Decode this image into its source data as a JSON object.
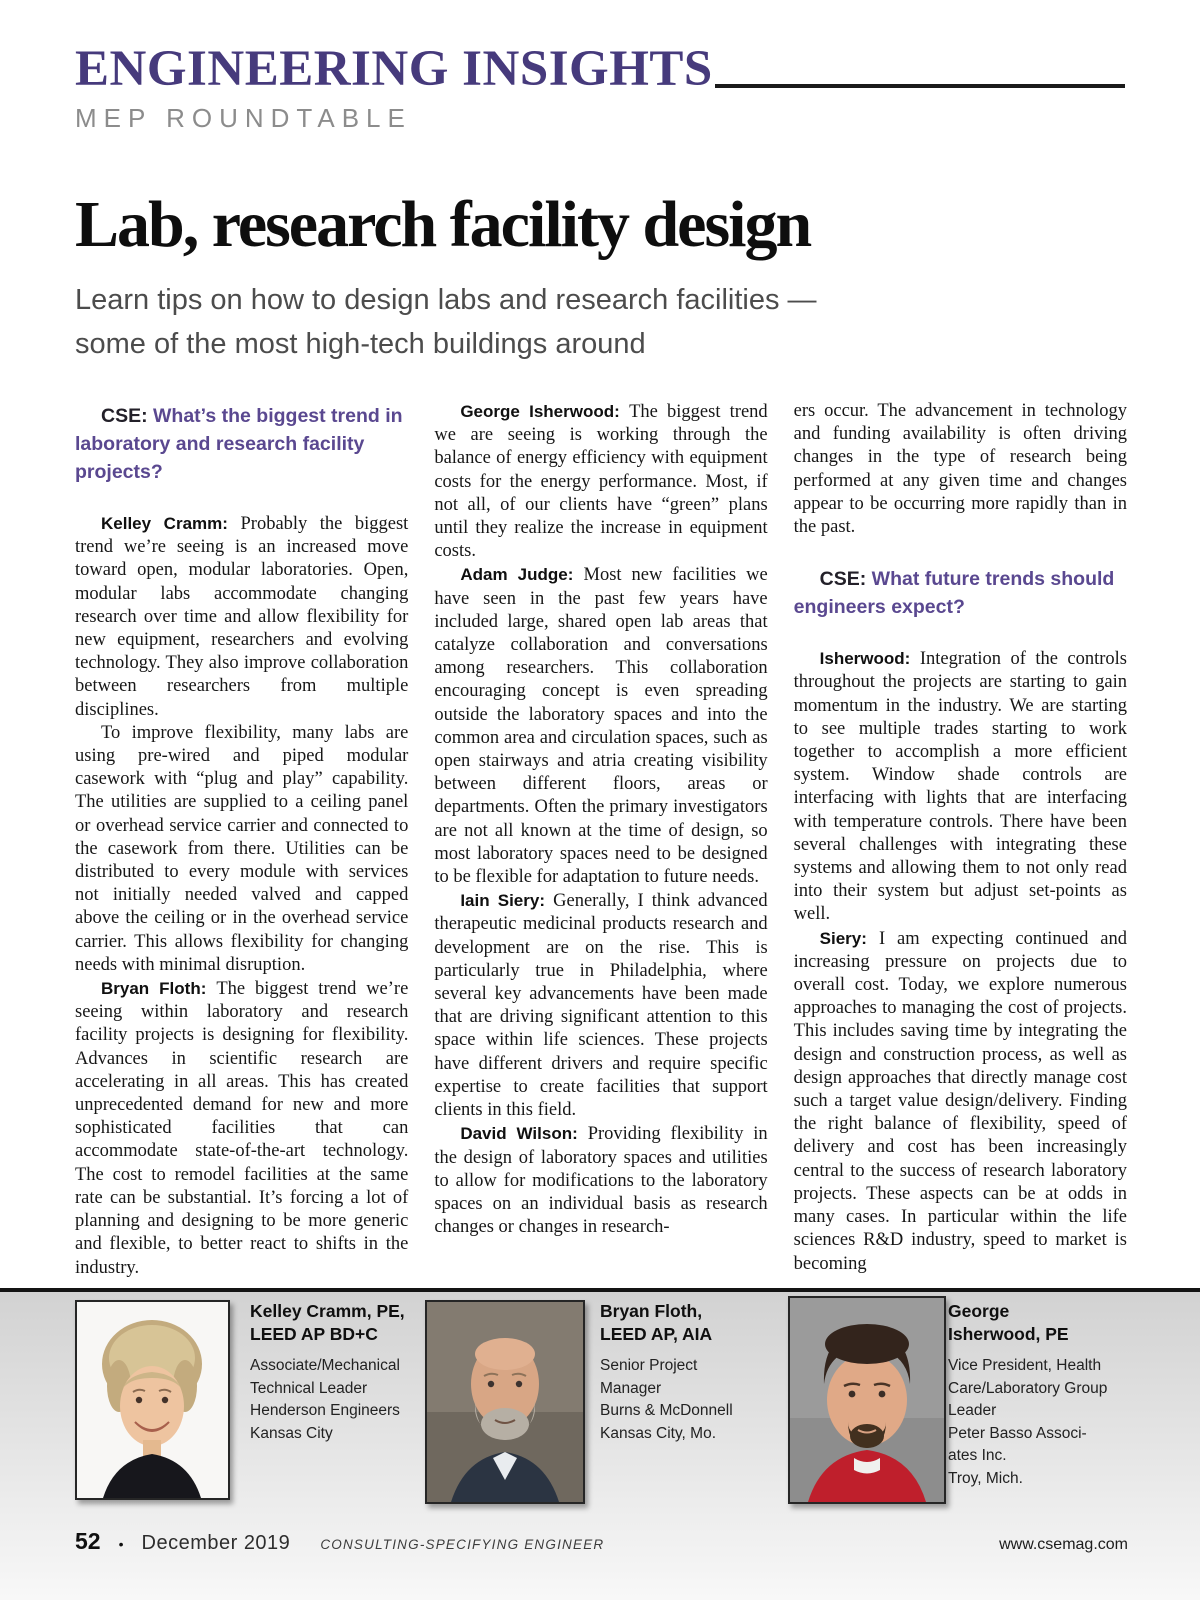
{
  "masthead": {
    "title": "ENGINEERING INSIGHTS",
    "subtitle": "MEP ROUNDTABLE"
  },
  "article": {
    "title": "Lab, research facility design",
    "subtitle_line1": "Learn tips on how to design labs and research facilities —",
    "subtitle_line2": "some of the most high-tech buildings around"
  },
  "columns": [
    {
      "blocks": [
        {
          "type": "question",
          "prefix": "CSE:",
          "text": "What’s the biggest trend in laboratory and research facility projects?"
        },
        {
          "type": "para",
          "speaker": "Kelley Cramm:",
          "text": "Probably the biggest trend we’re seeing is an increased move toward open, modular laboratories. Open, modular labs accommodate changing research over time and allow flexibility for new equipment, researchers and evolving technology. They also improve collaboration between researchers from multiple disciplines."
        },
        {
          "type": "para",
          "speaker": "",
          "text": "To improve flexibility, many labs are using pre-wired and piped modular casework with “plug and play” capability. The utilities are supplied to a ceiling panel or overhead service carrier and connected to the casework from there. Utilities can be distributed to every module with services not initially needed valved and capped above the ceiling or in the overhead service carrier. This allows flexibility for changing needs with minimal disruption."
        },
        {
          "type": "para",
          "speaker": "Bryan Floth:",
          "text": "The biggest trend we’re seeing within laboratory and research facility projects is designing for flexibility. Advances in scientific research are accelerating in all areas. This has created unprecedented demand for new and more sophisticated facilities that can accommodate state-of-the-art technology. The cost to remodel facilities at the same rate can be substantial. It’s forcing a lot of planning and designing to be more generic and flexible, to better react to shifts in the industry."
        }
      ]
    },
    {
      "blocks": [
        {
          "type": "para",
          "speaker": "George Isherwood:",
          "text": "The biggest trend we are seeing is working through the balance of energy efficiency with equipment costs for the energy performance. Most, if not all, of our clients have “green” plans until they realize the increase in equipment costs."
        },
        {
          "type": "para",
          "speaker": "Adam Judge:",
          "text": "Most new facilities we have seen in the past few years have included large, shared open lab areas that catalyze collaboration and conversations among researchers. This collaboration encouraging concept is even spreading outside the laboratory spaces and into the common area and circulation spaces, such as open stairways and atria creating visibility between different floors, areas or departments. Often the primary investigators are not all known at the time of design, so most laboratory spaces need to be designed to be flexible for adaptation to future needs."
        },
        {
          "type": "para",
          "speaker": "Iain Siery:",
          "text": "Generally, I think advanced therapeutic medicinal products research and development are on the rise. This is particularly true in Philadelphia, where several key advancements have been made that are driving significant attention to this space within life sciences. These projects have different drivers and require specific expertise to create facilities that support clients in this field."
        },
        {
          "type": "para",
          "speaker": "David Wilson:",
          "text": "Providing flexibility in the design of laboratory spaces and utilities to allow for modifications to the laboratory spaces on an individual basis as research changes or changes in research-"
        }
      ]
    },
    {
      "blocks": [
        {
          "type": "cont",
          "speaker": "",
          "text": "ers occur. The advancement in technology and funding availability is often driving changes in the type of research being performed at any given time and changes appear to be occurring more rapidly than in the past."
        },
        {
          "type": "question",
          "prefix": "CSE:",
          "text": "What future trends should engineers expect?"
        },
        {
          "type": "para",
          "speaker": "Isherwood:",
          "text": "Integration of the controls throughout the projects are starting to gain momentum in the industry. We are starting to see multiple trades starting to work together to accomplish a more efficient system. Window shade controls are interfacing with lights that are interfacing with temperature controls. There have been several challenges with integrating these systems and allowing them to not only read into their system but adjust set-points as well."
        },
        {
          "type": "para",
          "speaker": "Siery:",
          "text": "I am expecting continued and increasing pressure on projects due to overall cost. Today, we explore numerous approaches to managing the cost of projects. This includes saving time by integrating the design and construction process, as well as design approaches that directly manage cost such a target value design/delivery. Finding the right balance of flexibility, speed of delivery and cost has been increasingly central to the success of research laboratory projects. These aspects can be at odds in many cases. In particular within the life sciences R&D industry, speed to market is becoming"
        }
      ]
    }
  ],
  "bios": [
    {
      "name_lines": [
        "Kelley Cramm, PE,",
        "LEED AP BD+C"
      ],
      "details": [
        "Associate/Mechanical",
        "Technical Leader",
        "Henderson Engineers",
        "Kansas City"
      ]
    },
    {
      "name_lines": [
        "Bryan Floth,",
        "LEED AP, AIA"
      ],
      "details": [
        "Senior Project",
        "Manager",
        "Burns & McDonnell",
        "Kansas City, Mo."
      ]
    },
    {
      "name_lines": [
        "George",
        "Isherwood, PE"
      ],
      "details": [
        "Vice President, Health",
        "Care/Laboratory Group",
        "Leader",
        "Peter Basso Associ-",
        "ates Inc.",
        "Troy, Mich."
      ]
    }
  ],
  "footer": {
    "page_number": "52",
    "bullet": "•",
    "date": "December 2019",
    "magazine": "Consulting-Specifying Engineer",
    "website": "www.csemag.com"
  },
  "colors": {
    "masthead_purple": "#463a7c",
    "question_purple": "#5a4890",
    "rule_black": "#141414",
    "band_gray_top": "#d2d2d2",
    "george_shirt_red": "#bf1f2c"
  }
}
